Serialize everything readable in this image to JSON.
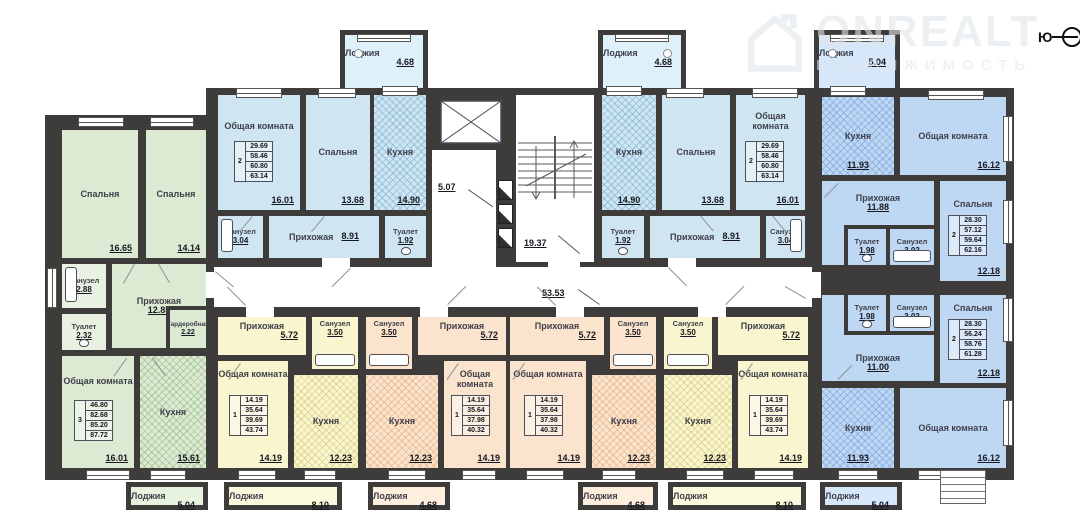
{
  "watermark": {
    "brand": "ONREALT",
    "subtitle": "НЕДВИЖИМОСТЬ"
  },
  "compass": {
    "south": "Ю"
  },
  "core": {
    "lobby": "5.07",
    "stairs": "19.37",
    "corridor": "53.53"
  },
  "apartments": {
    "left3": {
      "bedroom1": {
        "name": "Спальня",
        "area": "16.65"
      },
      "bedroom2": {
        "name": "Спальня",
        "area": "14.14"
      },
      "bathroom": {
        "name": "Санузел",
        "area": "2.88"
      },
      "wc": {
        "name": "Туалет",
        "area": "2.32"
      },
      "hallway": {
        "name": "Прихожая",
        "area": "12.85"
      },
      "wardrobe": {
        "name": "Гардеробная",
        "area": "2.22"
      },
      "living": {
        "name": "Общая комната",
        "area": "16.01"
      },
      "kitchen": {
        "name": "Кухня",
        "area": "15.61"
      },
      "stamp": {
        "rooms": "3",
        "v1": "46.80",
        "v2": "82.68",
        "v3": "85.20",
        "v4": "87.72"
      },
      "loggia": {
        "name": "Лоджия",
        "area": "5.04"
      }
    },
    "topL": {
      "living": {
        "name": "Общая комната",
        "area": "16.01"
      },
      "bedroom": {
        "name": "Спальня",
        "area": "13.68"
      },
      "kitchen": {
        "name": "Кухня",
        "area": "14.90"
      },
      "bathroom": {
        "name": "Санузел",
        "area": "3.04"
      },
      "hallway": {
        "name": "Прихожая",
        "area": "8.91"
      },
      "wc": {
        "name": "Туалет",
        "area": "1.92"
      },
      "stamp": {
        "rooms": "2",
        "v1": "29.69",
        "v2": "58.46",
        "v3": "60.80",
        "v4": "63.14"
      },
      "loggia": {
        "name": "Лоджия",
        "area": "4.68"
      }
    },
    "topR": {
      "kitchen": {
        "name": "Кухня",
        "area": "14.90"
      },
      "bedroom": {
        "name": "Спальня",
        "area": "13.68"
      },
      "living": {
        "name": "Общая комната",
        "area": "16.01"
      },
      "wc": {
        "name": "Туалет",
        "area": "1.92"
      },
      "hallway": {
        "name": "Прихожая",
        "area": "8.91"
      },
      "bathroom": {
        "name": "Санузел",
        "area": "3.04"
      },
      "stamp": {
        "rooms": "2",
        "v1": "29.69",
        "v2": "58.46",
        "v3": "60.80",
        "v4": "63.14"
      },
      "loggia": {
        "name": "Лоджия",
        "area": "4.68"
      }
    },
    "rightU": {
      "kitchen": {
        "name": "Кухня",
        "area": "11.93"
      },
      "living": {
        "name": "Общая комната",
        "area": "16.12"
      },
      "hallway": {
        "name": "Прихожая",
        "area": "11.88"
      },
      "wc": {
        "name": "Туалет",
        "area": "1.98"
      },
      "bathroom": {
        "name": "Санузел",
        "area": "3.03"
      },
      "bedroom": {
        "name": "Спальня",
        "area": "12.18"
      },
      "stamp": {
        "rooms": "2",
        "v1": "28.30",
        "v2": "57.12",
        "v3": "59.64",
        "v4": "62.16"
      },
      "loggia": {
        "name": "Лоджия",
        "area": "5.04"
      }
    },
    "rightL": {
      "wc": {
        "name": "Туалет",
        "area": "1.98"
      },
      "bathroom": {
        "name": "Санузел",
        "area": "3.03"
      },
      "bedroom": {
        "name": "Спальня",
        "area": "12.18"
      },
      "hallway": {
        "name": "Прихожая",
        "area": "11.00"
      },
      "kitchen": {
        "name": "Кухня",
        "area": "11.93"
      },
      "living": {
        "name": "Общая комната",
        "area": "16.12"
      },
      "stamp": {
        "rooms": "2",
        "v1": "28.30",
        "v2": "56.24",
        "v3": "58.76",
        "v4": "61.28"
      },
      "loggia": {
        "name": "Лоджия",
        "area": "5.04"
      }
    },
    "botA": {
      "hallway": {
        "name": "Прихожая",
        "area": "5.72"
      },
      "bathroom": {
        "name": "Санузел",
        "area": "3.50"
      },
      "living": {
        "name": "Общая комната",
        "area": "14.19"
      },
      "kitchen": {
        "name": "Кухня",
        "area": "12.23"
      },
      "stamp": {
        "rooms": "1",
        "v1": "14.19",
        "v2": "35.64",
        "v3": "39.69",
        "v4": "43.74"
      },
      "loggia": {
        "name": "Лоджия",
        "area": "8.10"
      }
    },
    "botB": {
      "bathroom": {
        "name": "Санузел",
        "area": "3.50"
      },
      "hallway": {
        "name": "Прихожая",
        "area": "5.72"
      },
      "kitchen": {
        "name": "Кухня",
        "area": "12.23"
      },
      "living": {
        "name": "Общая комната",
        "area": "14.19"
      },
      "stamp": {
        "rooms": "1",
        "v1": "14.19",
        "v2": "35.64",
        "v3": "37.98",
        "v4": "40.32"
      },
      "loggia": {
        "name": "Лоджия",
        "area": "4.68"
      }
    },
    "botC": {
      "hallway": {
        "name": "Прихожая",
        "area": "5.72"
      },
      "bathroom": {
        "name": "Санузел",
        "area": "3.50"
      },
      "living": {
        "name": "Общая комната",
        "area": "14.19"
      },
      "kitchen": {
        "name": "Кухня",
        "area": "12.23"
      },
      "stamp": {
        "rooms": "1",
        "v1": "14.19",
        "v2": "35.64",
        "v3": "37.98",
        "v4": "40.32"
      },
      "loggia": {
        "name": "Лоджия",
        "area": "4.68"
      }
    },
    "botD": {
      "bathroom": {
        "name": "Санузел",
        "area": "3.50"
      },
      "hallway": {
        "name": "Прихожая",
        "area": "5.72"
      },
      "kitchen": {
        "name": "Кухня",
        "area": "12.23"
      },
      "living": {
        "name": "Общая комната",
        "area": "14.19"
      },
      "stamp": {
        "rooms": "1",
        "v1": "14.19",
        "v2": "35.64",
        "v3": "39.69",
        "v4": "43.74"
      },
      "loggia": {
        "name": "Лоджия",
        "area": "8.10"
      }
    }
  },
  "colors": {
    "wall": "#3d3c3a",
    "green": "#dcead3",
    "light_blue": "#cfe6f2",
    "blue": "#bed8f4",
    "yellow": "#f8f5cf",
    "peach": "#fae4cd"
  }
}
